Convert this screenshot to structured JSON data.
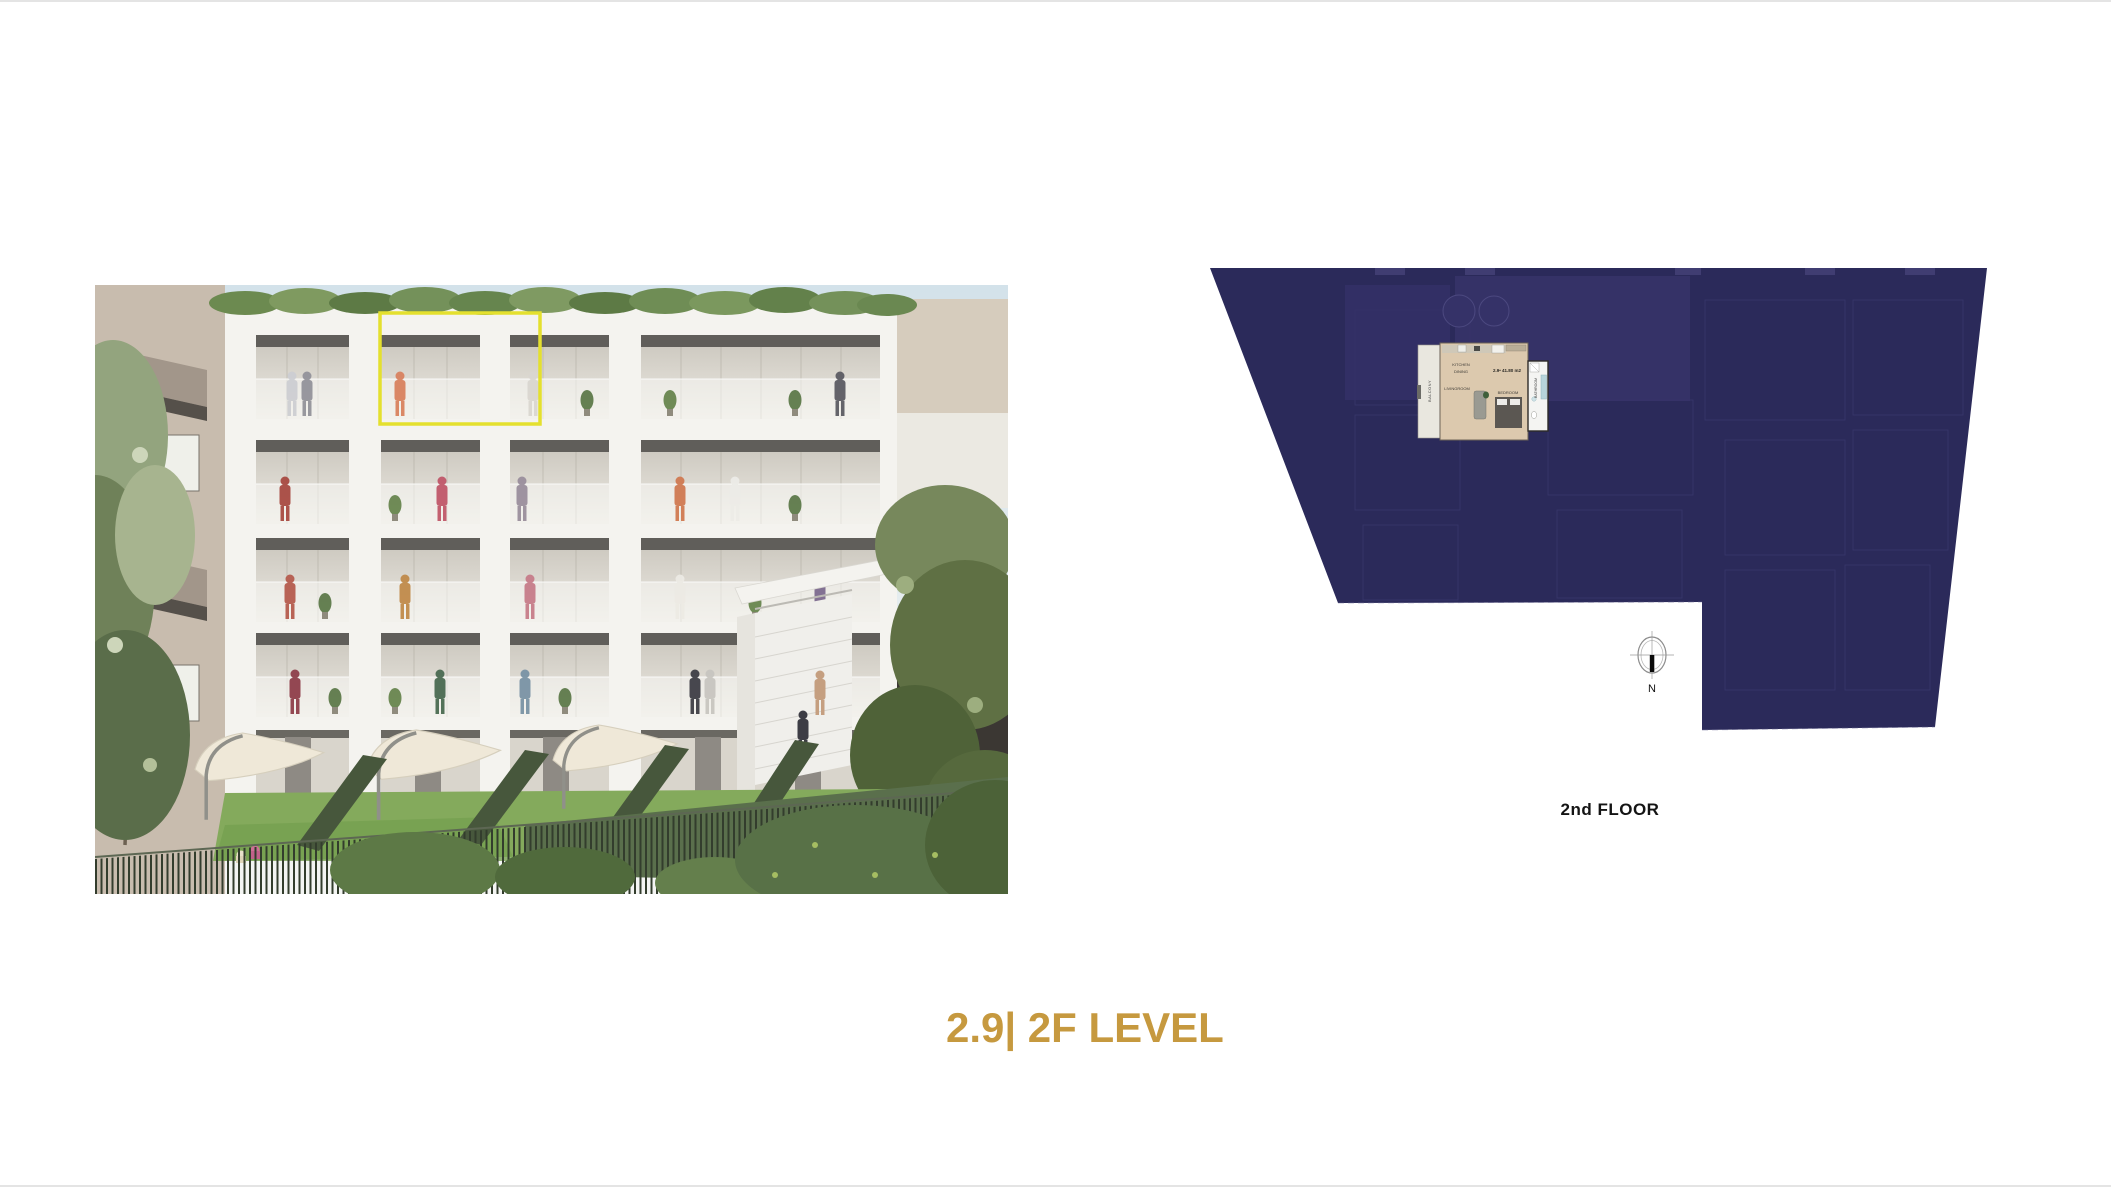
{
  "slide": {
    "title": "2.9| 2F LEVEL",
    "title_color": "#c6993f"
  },
  "rendering": {
    "highlight_color": "#e4e02e"
  },
  "floor_plan": {
    "floor_label": "2nd FLOOR",
    "compass_label": "N",
    "plan_color": "#2b2a5a",
    "unit": {
      "area_label": "2.9• 41.80 m2",
      "balcony_label": "BALCONY",
      "kitchen_label": "KITCHEN",
      "dining_label": "DINING",
      "livingroom_label": "LIVINGROOM",
      "bedroom_label": "BEDROOM",
      "bathroom_label": "BATHROOM"
    }
  }
}
